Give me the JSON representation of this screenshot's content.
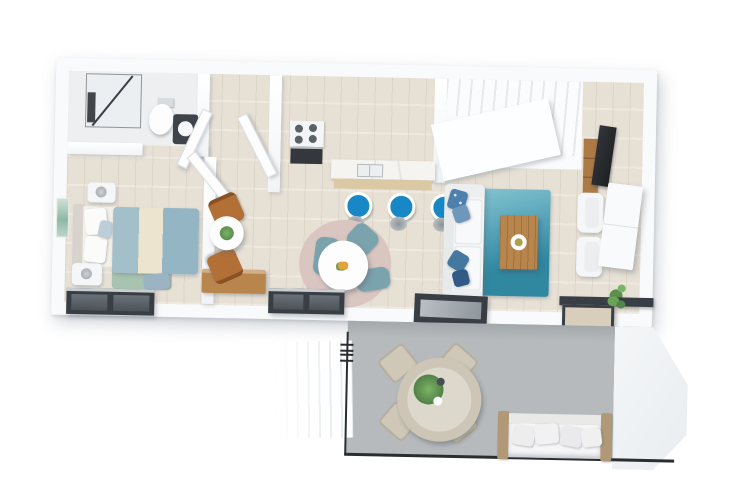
{
  "scene": {
    "type": "3d-floor-plan-top-down-render",
    "background": "#ffffff",
    "building_outline": "white walls, light wood interior floor, concrete terrace"
  },
  "palette": {
    "wall": "#f9fafb",
    "wood_floor": "#e7e0d5",
    "bathroom_floor": "#edeff0",
    "terrace_floor": "#b6babc",
    "frame_dark": "#383e44",
    "rail_black": "#2b2e31",
    "stool_blue": "#1787c5",
    "rug_teal_dark": "#2f87a0",
    "rug_teal_light": "#84c4d2",
    "chair_muted_teal": "#7ba3ad",
    "rug_dusty_pink": "#dac6c0",
    "rug_sage": "#a9c3b1",
    "bed_teal": "#9cbac6",
    "bed_cream": "#ece4cf",
    "chair_caramel": "#b26f36",
    "wood_furniture": "#b8854d",
    "wood_counter_base": "#dbc9a5",
    "outdoor_beige": "#cfc8b8",
    "outdoor_wood": "#b19877",
    "plant_green": "#5c8f4e",
    "sofa_white": "#f4f5f6",
    "pillow_blue": "#4d80ad",
    "tv_black": "#24272a",
    "vanity_dark": "#3f444a",
    "oven_dark": "#34383c"
  },
  "rooms": [
    {
      "id": "bathroom",
      "name": "Bathroom",
      "furniture": [
        "glass shower",
        "toilet",
        "dark vanity with round sink"
      ]
    },
    {
      "id": "bedroom",
      "name": "Bedroom",
      "furniture": [
        "double bed with teal and cream bedding",
        "two white nightstands with lamps",
        "teal wall art",
        "sage green rug",
        "blue bench",
        "window"
      ]
    },
    {
      "id": "hallway",
      "name": "Entry Hall",
      "furniture": [
        "entry door",
        "round white table with plant",
        "two caramel leather chairs",
        "wooden console desk"
      ]
    },
    {
      "id": "kitchen",
      "name": "Kitchen / Dining",
      "furniture": [
        "stove with oven",
        "marble island with sink",
        "three blue bar stools",
        "round dining table",
        "muted teal dining chairs",
        "dusty pink round rug",
        "window"
      ]
    },
    {
      "id": "living",
      "name": "Living Room",
      "furniture": [
        "white staircase",
        "white sofa with blue pillows",
        "teal area rug",
        "wood coffee table with plate",
        "tv on wood cabinet",
        "white sideboard",
        "two white armchairs",
        "floor plant",
        "window",
        "sliding door"
      ]
    },
    {
      "id": "terrace",
      "name": "Terrace",
      "furniture": [
        "round outdoor table with plant",
        "four beige outdoor chairs",
        "outdoor sofa with wood frame",
        "glass railing",
        "exterior stairs"
      ]
    }
  ]
}
